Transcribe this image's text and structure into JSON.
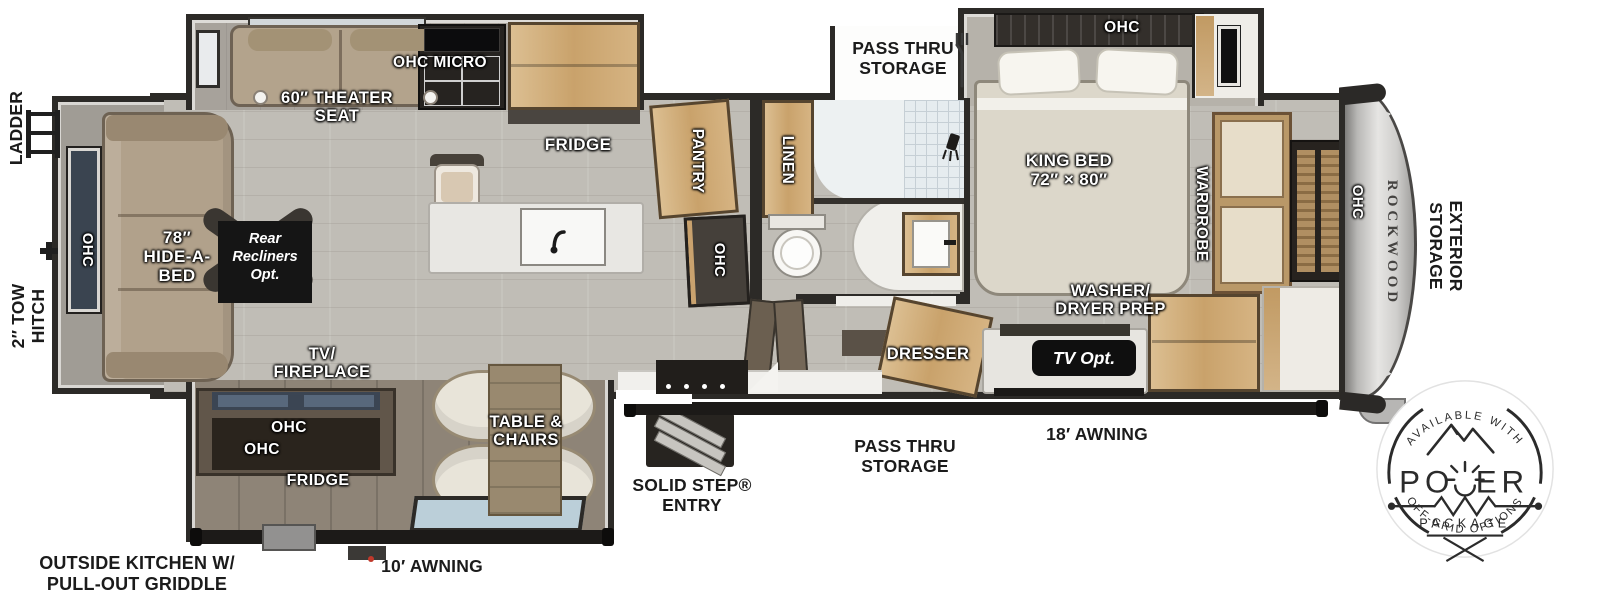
{
  "colors": {
    "wall": "#2c2a27",
    "floor": "#c0bdb6",
    "wood": "#cfa873",
    "awning": "#1c1a18",
    "label_dark": "#1b1b1b"
  },
  "brand": {
    "name": "ROCKWOOD"
  },
  "exterior": {
    "ladder": "LADDER",
    "tow_hitch": [
      "2″ TOW",
      "HITCH"
    ],
    "outside_kitchen": [
      "OUTSIDE KITCHEN W/",
      "PULL-OUT GRIDDLE"
    ],
    "awning_rear": "10′ AWNING",
    "solid_step": [
      "SOLID STEP®",
      "ENTRY"
    ],
    "pass_thru_bottom": [
      "PASS THRU",
      "STORAGE"
    ],
    "awning_front": "18′ AWNING",
    "pass_thru_top": [
      "PASS THRU",
      "STORAGE"
    ],
    "exterior_storage": [
      "EXTERIOR",
      "STORAGE"
    ]
  },
  "interior": {
    "rear_ohc": "OHC",
    "hide_a_bed": [
      "78″",
      "HIDE-A-",
      "BED"
    ],
    "rear_recliners": [
      "Rear",
      "Recliners",
      "Opt."
    ],
    "theater_seat": [
      "60″ THEATER",
      "SEAT"
    ],
    "ohc_micro": "OHC MICRO",
    "fridge": "FRIDGE",
    "pantry": "PANTRY",
    "pantry_ohc": "OHC",
    "linen": "LINEN",
    "king_bed": [
      "KING BED",
      "72″ × 80″"
    ],
    "bed_ohc": "OHC",
    "wardrobe": "WARDROBE",
    "washer_dryer": [
      "WASHER/",
      "DRYER PREP"
    ],
    "dresser": "DRESSER",
    "tv_opt": "TV Opt.",
    "front_ohc": "OHC",
    "tv_fireplace": [
      "TV/",
      "FIREPLACE"
    ],
    "outside_ohc_upper": "OHC",
    "outside_ohc_lower": "OHC",
    "outside_fridge": "FRIDGE",
    "table_chairs": [
      "TABLE &",
      "CHAIRS"
    ]
  },
  "badge": {
    "arc_top": "AVAILABLE WITH",
    "power_left": "PO",
    "power_right": "ER",
    "power_word": "POWER",
    "package": "PACKAGE",
    "arc_bottom": "OFF-GRID OPTIONS"
  }
}
